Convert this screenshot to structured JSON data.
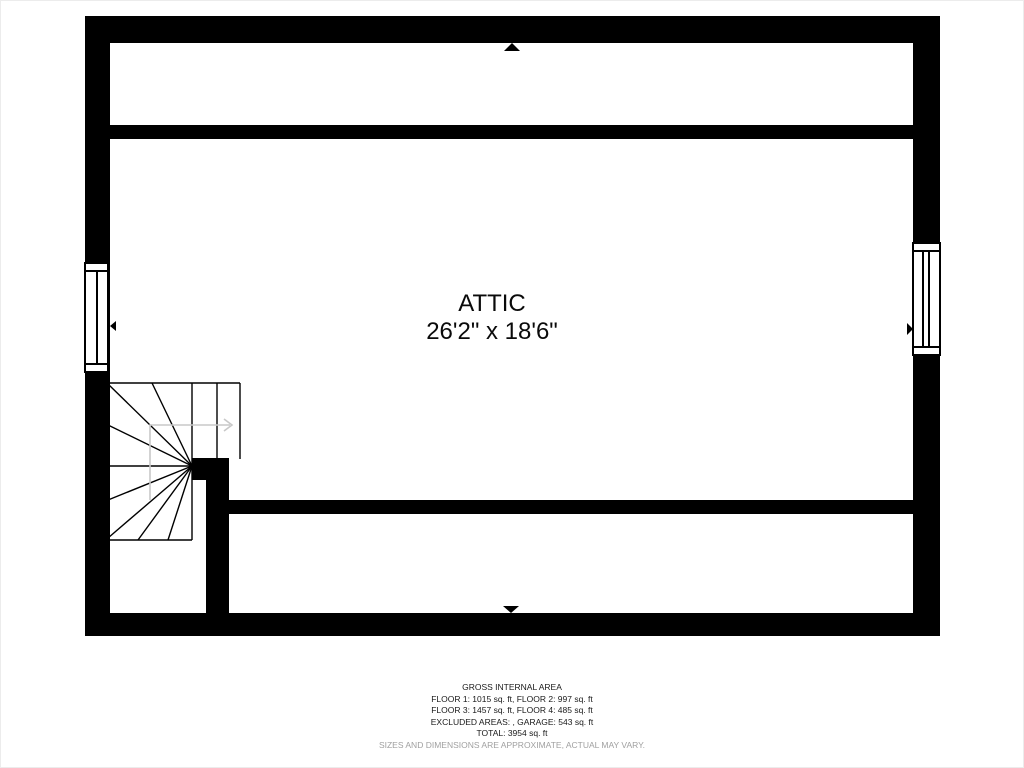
{
  "colors": {
    "wall": "#000000",
    "text": "#0a0a0a",
    "disclaimer": "#a0a0a0",
    "stair_arrow": "#c8c8c8",
    "background": "#ffffff"
  },
  "room": {
    "label": "ATTIC",
    "dimensions": "26'2\" x 18'6\""
  },
  "footer": {
    "title": "GROSS INTERNAL AREA",
    "lines": [
      "FLOOR 1: 1015 sq. ft, FLOOR 2: 997 sq. ft",
      "FLOOR 3: 1457 sq. ft, FLOOR 4: 485 sq. ft",
      "EXCLUDED AREAS: , GARAGE: 543 sq. ft",
      "TOTAL: 3954 sq. ft"
    ],
    "disclaimer": "SIZES AND DIMENSIONS ARE APPROXIMATE, ACTUAL MAY VARY."
  }
}
